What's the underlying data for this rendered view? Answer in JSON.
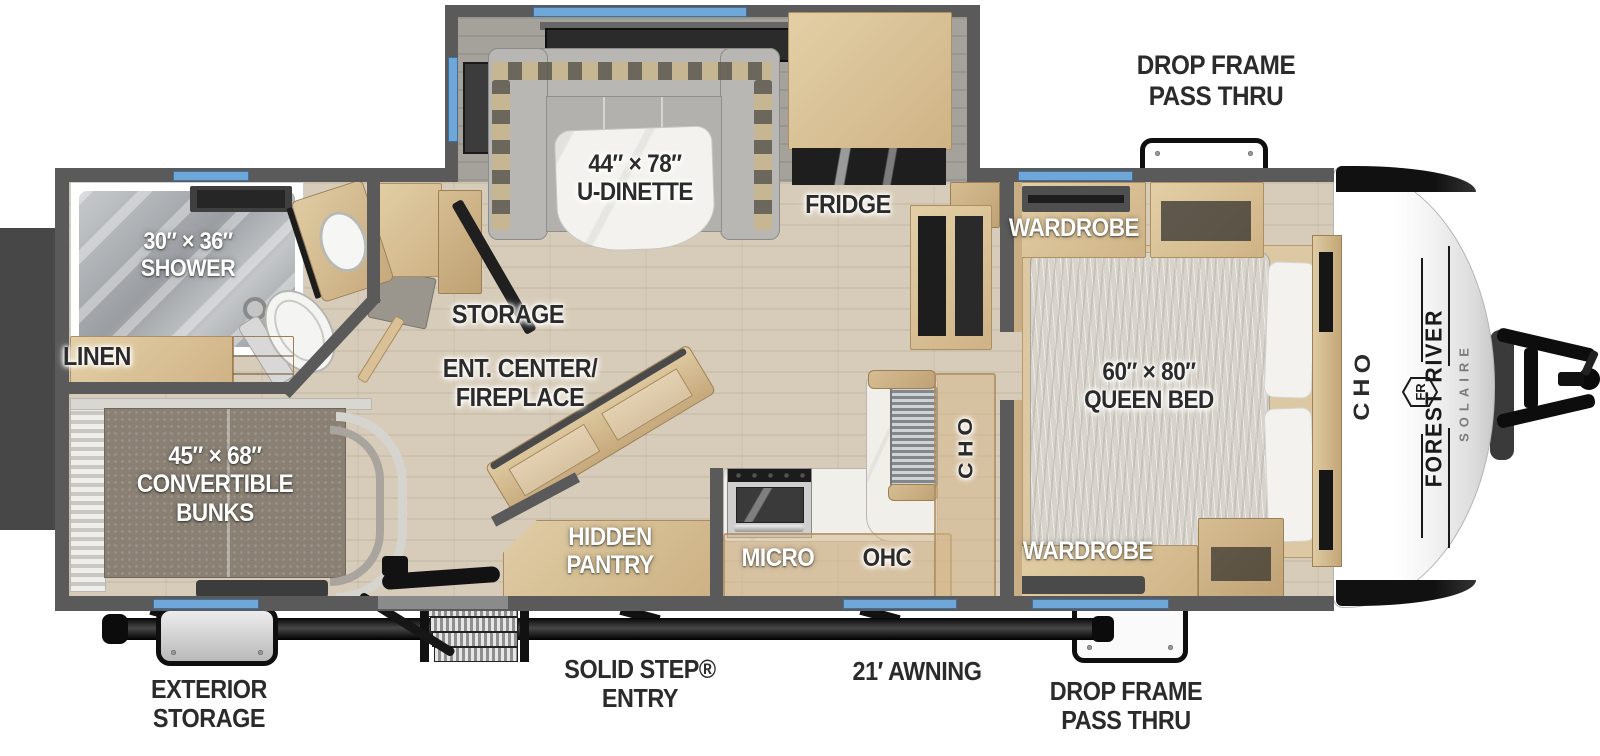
{
  "labels": {
    "drop_frame_top": "DROP FRAME\nPASS THRU",
    "drop_frame_bottom": "DROP FRAME\nPASS THRU",
    "exterior_storage": "EXTERIOR\nSTORAGE",
    "solid_step_entry": "SOLID STEP®\nENTRY",
    "awning": "21′ AWNING",
    "shower": "30″ × 36″\nSHOWER",
    "linen": "LINEN",
    "bunks": "45″ × 68″\nCONVERTIBLE\nBUNKS",
    "storage": "STORAGE",
    "ent_center": "ENT. CENTER/\nFIREPLACE",
    "u_dinette": "44″ × 78″\nU-DINETTE",
    "fridge": "FRIDGE",
    "hidden_pantry": "HIDDEN\nPANTRY",
    "micro": "MICRO",
    "ohc_kitchen": "OHC",
    "ohc_kitchen_vertical": "OHC",
    "ohc_bedroom": "OHC",
    "wardrobe_top": "WARDROBE",
    "wardrobe_bottom": "WARDROBE",
    "queen_bed": "60″ × 80″\nQUEEN BED"
  },
  "brand": {
    "manufacturer": "FOREST RIVER",
    "model": "SOLAIRE",
    "logo_monogram": "FR"
  },
  "colors": {
    "wall": "#5a5a5a",
    "window_blue": "#6ea7d8",
    "floor_wood": "#d7ccb9",
    "cabinet_tan": "#d2b78c",
    "label_dark": "#2b2b2b",
    "label_light": "#ffffff"
  }
}
